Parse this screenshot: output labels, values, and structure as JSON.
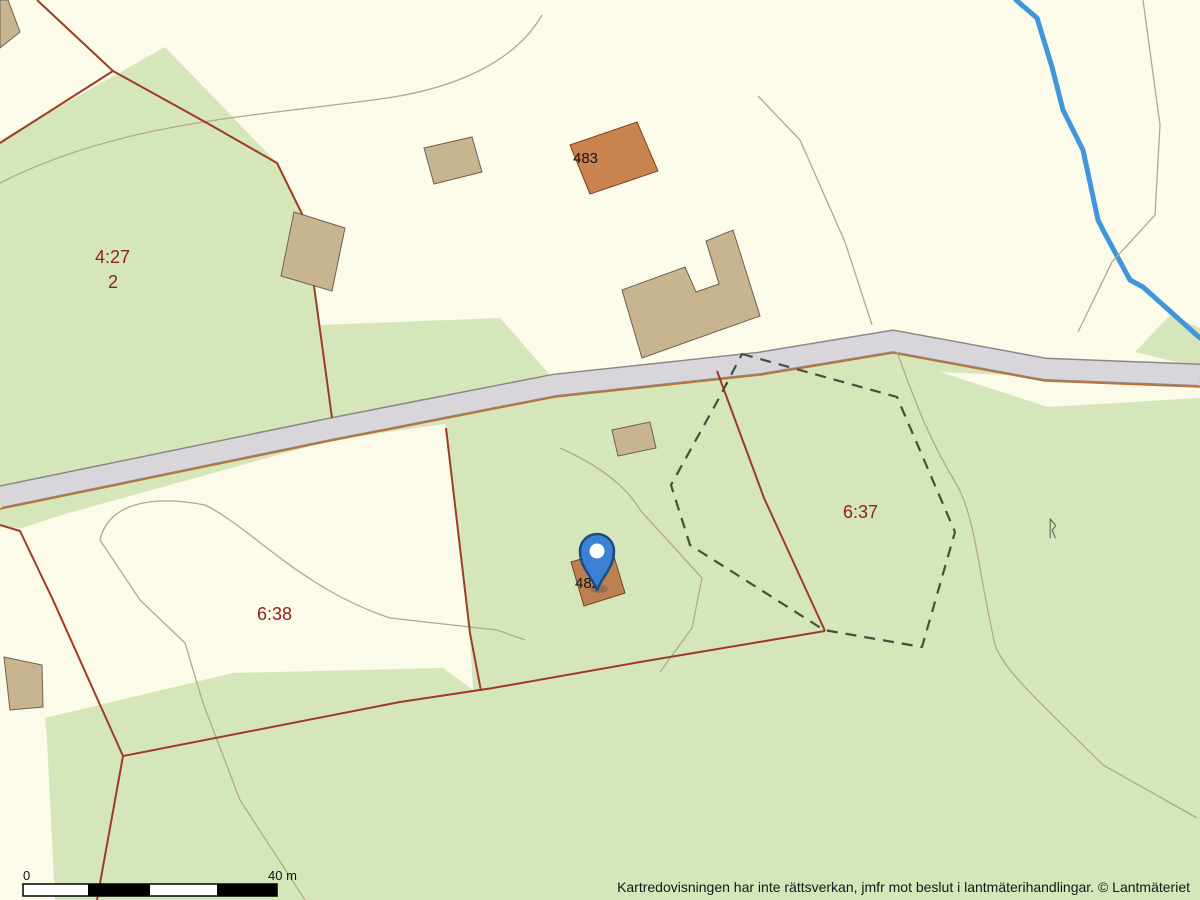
{
  "map": {
    "type": "cadastral-map",
    "parcel_labels": [
      {
        "text": "4:27"
      },
      {
        "text": "2"
      },
      {
        "text": "6:38"
      },
      {
        "text": "6:37"
      }
    ],
    "building_labels": [
      {
        "text": "483"
      },
      {
        "text": "482"
      }
    ],
    "ancient_monument_symbol": {
      "text": "ᚱ"
    },
    "marker": {
      "kind": "location-pin",
      "color": "#3b82d4"
    },
    "colors": {
      "background_open_land": "#fcfae8",
      "forest_green": "#d5e7ba",
      "road_fill": "#d8d6db",
      "road_casing": "#8a8884",
      "parcel_boundary_red": "#9e3b26",
      "road_parcel_line_orange": "#c07030",
      "survey_dashed_line": "#44503f",
      "footpath_tan": "#b5a78b",
      "stream_blue": "#3f96dc",
      "building_fill": "#c9b490",
      "building_483_fill": "#c9834e",
      "label_red": "#8e231a"
    }
  },
  "scalebar": {
    "start_label": "0",
    "end_label": "40 m"
  },
  "attribution": "Kartredovisningen har inte rättsverkan, jmfr mot beslut i lantmäterihandlingar. © Lantmäteriet"
}
